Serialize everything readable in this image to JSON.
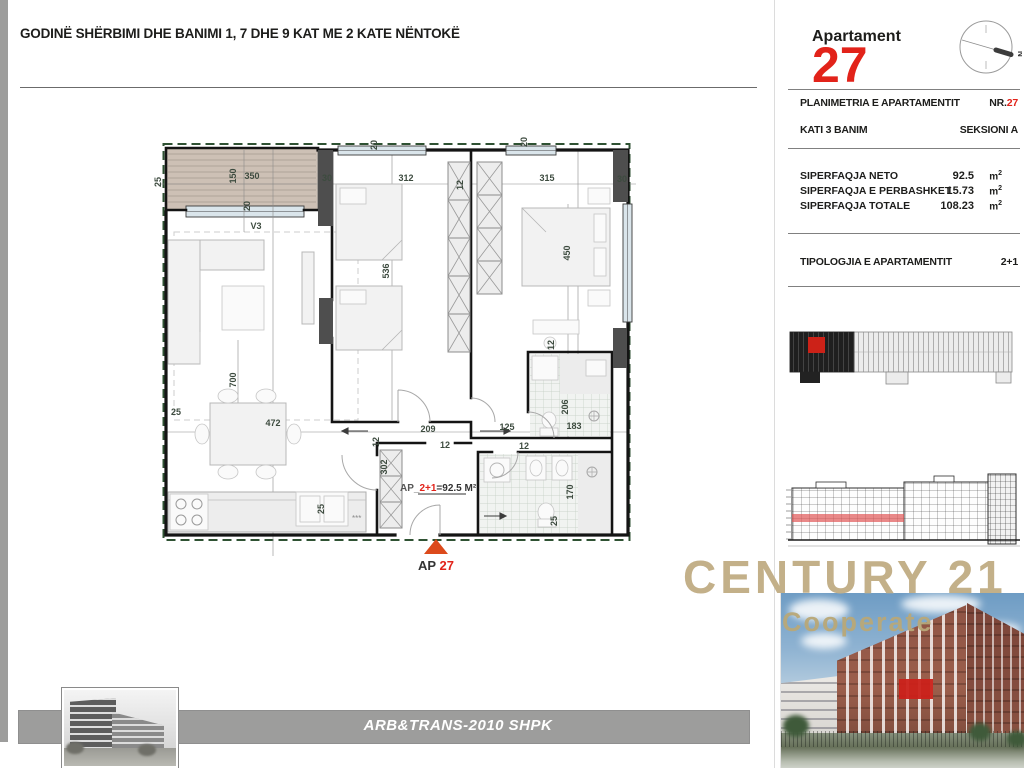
{
  "sheet": {
    "title": "GODINË  SHËRBIMI DHE BANIMI 1, 7 DHE 9 KAT ME 2 KATE NËNTOKË"
  },
  "header": {
    "apartment_label": "Apartament",
    "apartment_number": "27",
    "compass_north": "N"
  },
  "panel": {
    "row1_label": "PLANIMETRIA E APARTAMENTIT",
    "row1_value_prefix": "NR.",
    "row1_value_number": "27",
    "row2_label": "KATI 3 BANIM",
    "row2_value": "SEKSIONI A",
    "areas": [
      {
        "label": "SIPERFAQJA NETO",
        "value": "92.5"
      },
      {
        "label": "SIPERFAQJA E PERBASHKET",
        "value": "15.73"
      },
      {
        "label": "SIPERFAQJA TOTALE",
        "value": "108.23"
      }
    ],
    "unit": "m",
    "unit_sup": "2",
    "typology_label": "TIPOLOGJIA E APARTAMENTIT",
    "typology_value": "2+1"
  },
  "plan": {
    "unit_label_prefix": "AP_",
    "unit_label_typology": "2+1",
    "unit_label_area": "=92.5 M²",
    "entrance_label_prefix": "AP ",
    "entrance_label_number": "27",
    "sink_marks": "***",
    "dims": [
      {
        "t": "25",
        "x": 161,
        "y": 182,
        "r": -90
      },
      {
        "t": "150",
        "x": 236,
        "y": 176,
        "r": -90
      },
      {
        "t": "350",
        "x": 252,
        "y": 179,
        "r": 0
      },
      {
        "t": "20",
        "x": 250,
        "y": 206,
        "r": -90
      },
      {
        "t": "V3",
        "x": 256,
        "y": 229,
        "r": 0
      },
      {
        "t": "30",
        "x": 327,
        "y": 181,
        "r": 0
      },
      {
        "t": "20",
        "x": 377,
        "y": 145,
        "r": -90
      },
      {
        "t": "312",
        "x": 406,
        "y": 181,
        "r": 0
      },
      {
        "t": "12",
        "x": 463,
        "y": 185,
        "r": -90
      },
      {
        "t": "315",
        "x": 547,
        "y": 181,
        "r": 0
      },
      {
        "t": "20",
        "x": 527,
        "y": 142,
        "r": -90
      },
      {
        "t": "30",
        "x": 622,
        "y": 182,
        "r": 0
      },
      {
        "t": "536",
        "x": 389,
        "y": 271,
        "r": -90
      },
      {
        "t": "450",
        "x": 570,
        "y": 253,
        "r": -90
      },
      {
        "t": "700",
        "x": 236,
        "y": 380,
        "r": -90
      },
      {
        "t": "25",
        "x": 176,
        "y": 415,
        "r": 0
      },
      {
        "t": "472",
        "x": 273,
        "y": 426,
        "r": 0
      },
      {
        "t": "209",
        "x": 428,
        "y": 432,
        "r": 0
      },
      {
        "t": "125",
        "x": 507,
        "y": 430,
        "r": 0
      },
      {
        "t": "183",
        "x": 574,
        "y": 429,
        "r": 0
      },
      {
        "t": "12",
        "x": 379,
        "y": 442,
        "r": -90
      },
      {
        "t": "302",
        "x": 387,
        "y": 467,
        "r": -90
      },
      {
        "t": "12",
        "x": 445,
        "y": 448,
        "r": 0
      },
      {
        "t": "12",
        "x": 524,
        "y": 449,
        "r": 0
      },
      {
        "t": "12",
        "x": 554,
        "y": 345,
        "r": -90
      },
      {
        "t": "206",
        "x": 568,
        "y": 407,
        "r": -90
      },
      {
        "t": "170",
        "x": 573,
        "y": 492,
        "r": -90
      },
      {
        "t": "25",
        "x": 557,
        "y": 521,
        "r": -90
      },
      {
        "t": "25",
        "x": 324,
        "y": 509,
        "r": -90
      }
    ]
  },
  "branding": {
    "brand": "CENTURY 21",
    "sub": "Cooperate",
    "footer": "ARB&TRANS-2010 SHPK"
  },
  "colors": {
    "accent_red": "#e2231a",
    "brand_gold": "#c3b089",
    "bar_gray": "#9d9d9c",
    "dim_green": "#3d4b3f",
    "entrance_arrow": "#dc4a1c"
  }
}
